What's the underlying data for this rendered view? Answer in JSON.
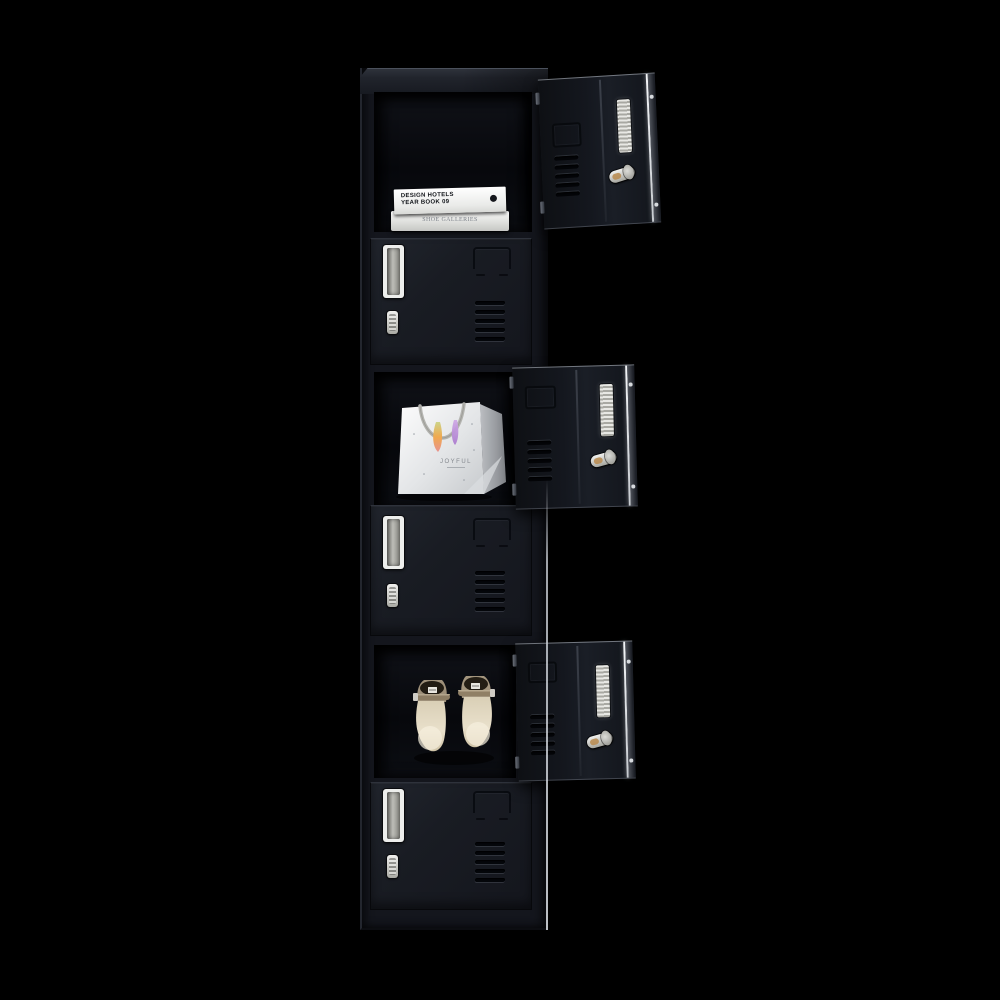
{
  "scene": {
    "type": "product-photograph",
    "subject": "Six-door black metal storage locker; three doors open showing contents",
    "background_color": "#000000"
  },
  "locker": {
    "body_color": "#15181f",
    "door_color": "#1a1d25",
    "hardware_silver": "#d6d6d2",
    "door_features": [
      "recessed-handle",
      "cam-lock",
      "label-holder",
      "ventilation-slots"
    ],
    "compartments": [
      {
        "position": 1,
        "state": "open",
        "contents": "stacked white books"
      },
      {
        "position": 2,
        "state": "closed",
        "contents": ""
      },
      {
        "position": 3,
        "state": "open",
        "contents": "white gift bag"
      },
      {
        "position": 4,
        "state": "closed",
        "contents": ""
      },
      {
        "position": 5,
        "state": "open",
        "contents": "pair of beige high-heel shoes"
      },
      {
        "position": 6,
        "state": "closed",
        "contents": ""
      }
    ]
  },
  "books": {
    "top_book_line1": "DESIGN HOTELS",
    "top_book_line2": "YEAR BOOK 09",
    "bottom_book_title": "SHOE GALLERIES"
  },
  "gift_bag": {
    "label": "JOYFUL"
  }
}
